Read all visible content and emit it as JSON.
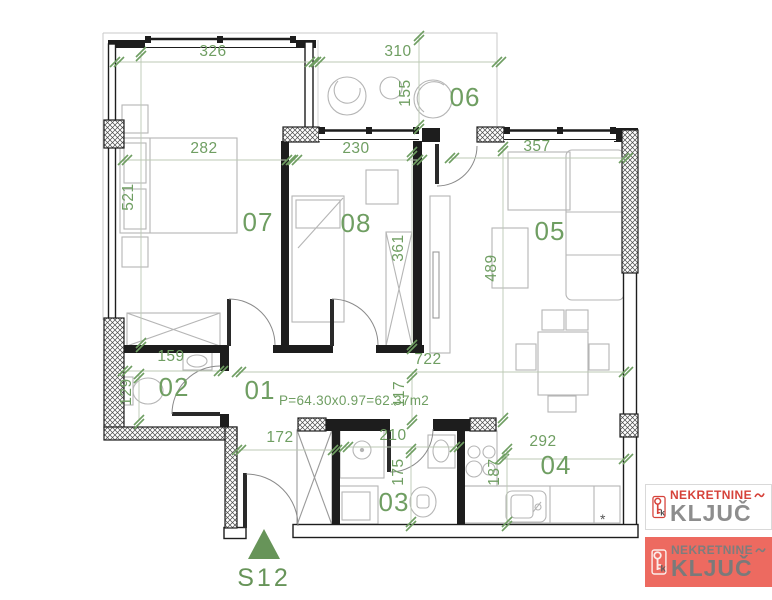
{
  "plan": {
    "area_text": "P=64.30x0.97=62.37m2",
    "entrance_label": "S12",
    "footnote": "*",
    "rooms": {
      "r01": "01",
      "r02": "02",
      "r03": "03",
      "r04": "04",
      "r05": "05",
      "r06": "06",
      "r07": "07",
      "r08": "08"
    },
    "dimensions": {
      "d326": "326",
      "d310": "310",
      "d155": "155",
      "d282": "282",
      "d230": "230",
      "d357": "357",
      "d521": "521",
      "d361": "361",
      "d489": "489",
      "d159": "159",
      "d129": "129",
      "d722": "722",
      "d117": "117",
      "d172": "172",
      "d210": "210",
      "d175": "175",
      "d292": "292",
      "d187": "187"
    },
    "colors": {
      "dimension_green": "#6f9e62",
      "wall_black": "#1d1d1d",
      "furniture_gray": "#b5b5b5",
      "logo_red": "#d6423a",
      "logo_salmon": "#ed6a60",
      "logo_gray": "#8d8d8d"
    }
  },
  "logo": {
    "brand_top": "NEKRETNINE",
    "brand_main": "KLJUČ",
    "icon_letter": "k"
  }
}
